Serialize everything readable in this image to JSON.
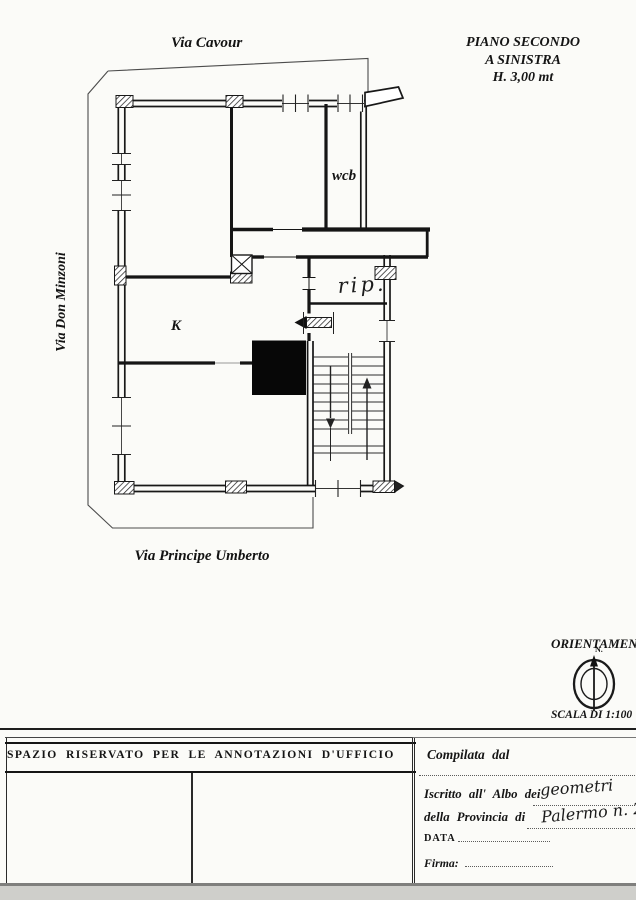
{
  "header": {
    "street_top": "Via Cavour",
    "title_line1": "PIANO SECONDO",
    "title_line2": "A SINISTRA",
    "title_line3": "H. 3,00 mt"
  },
  "plan": {
    "street_left": "Via Don Minzoni",
    "street_bottom": "Via Principe Umberto",
    "room_kitchen": "K",
    "room_wc": "wcb",
    "room_storage": "rip."
  },
  "orientation": {
    "title": "ORIENTAMENTO",
    "north_label": "N.",
    "scale_label": "SCALA DI 1:100"
  },
  "office_box": {
    "header": "SPAZIO RISERVATO PER LE ANNOTAZIONI D'UFFICIO"
  },
  "form": {
    "compiled_label": "Compilata dal",
    "register_label_1": "Iscritto all' Albo dei",
    "register_value_1": "geometri",
    "register_label_2": "della Provincia di",
    "register_value_2": "Palermo n. 2",
    "date_label": "DATA",
    "signature_label": "Firma:"
  }
}
